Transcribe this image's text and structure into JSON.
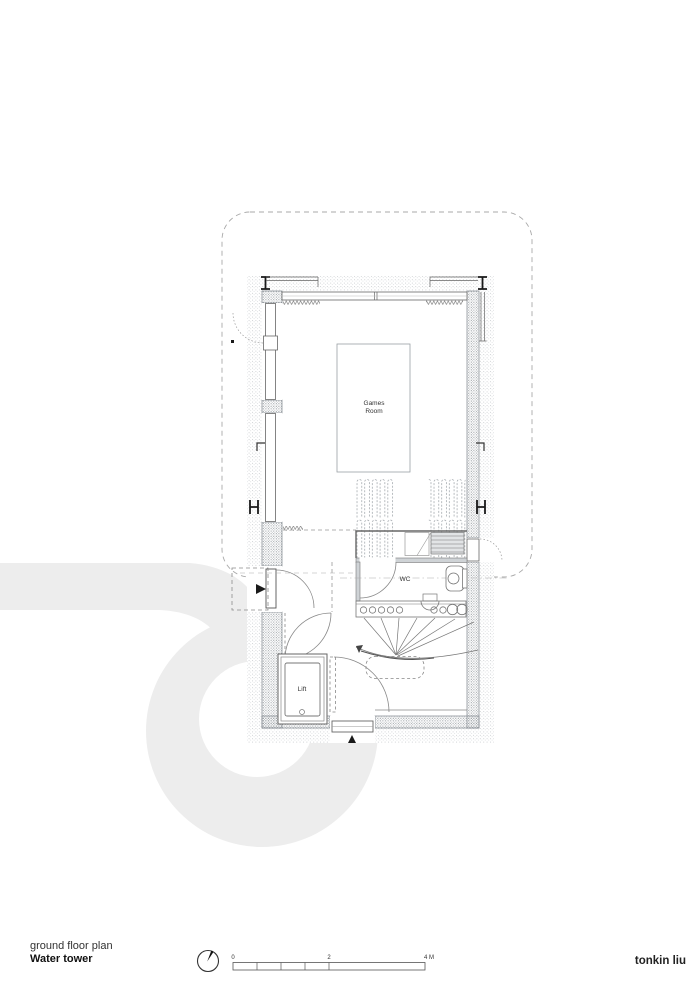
{
  "title_block": {
    "project_line": "ground floor plan",
    "name_line": "Water tower"
  },
  "labels": {
    "games_line1": "Games",
    "games_line2": "Room",
    "wc": "WC",
    "lift": "Lift"
  },
  "scale_bar": {
    "t0": "0",
    "t2": "2",
    "t4": "4 M"
  },
  "north_arrow": {
    "name": "north-arrow"
  },
  "logo": {
    "text": "tonkin liu",
    "color": "#d52b2e"
  },
  "colors": {
    "watermark": "#ededed",
    "wall_speckle": "#8f959a",
    "stipple": "#a8adb2",
    "line_dark": "#1a1a1a",
    "line_mid": "#777777"
  }
}
